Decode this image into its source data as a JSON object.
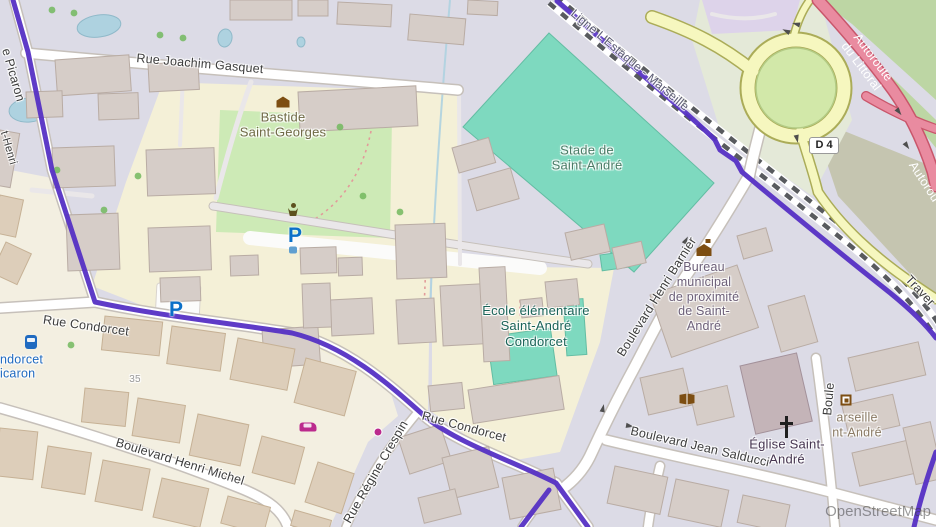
{
  "attribution": "OpenStreetMap",
  "shield": {
    "label": "D 4"
  },
  "colors": {
    "base": "#dcdbe6",
    "cream": "#f3efe1",
    "parkGreen": "#cdeab6",
    "schoolYellow": "#f4f0d7",
    "pitch": "#7ed9bf",
    "pitchBorder": "#63bda3",
    "khaki": "#c5c5b0",
    "scrub": "#bdd6a4",
    "roundBg": "#e4e9d8",
    "lavender": "#ddd3ea",
    "roadFill": "#ffffff",
    "roadCasing": "#c6c0ba",
    "trackFill": "#eae7e9",
    "yellowFill": "#f6f7bf",
    "yellowCasing": "#abac58",
    "greenCtr": "#d2e8a9",
    "motFill": "#e98ba0",
    "motCasing": "#c9566b",
    "railDark": "#585a5e",
    "route": "#5530c4",
    "water": "#aed2e0",
    "waterBorder": "#8fb9c9",
    "bldgG": "#d6cdc8",
    "bldgGB": "#b9aca4",
    "bldgT": "#ddceba",
    "bldgTB": "#c6b195",
    "church": "#c4b4b8",
    "churchB": "#a3919a",
    "tree": "#72b95e",
    "labelRoad": "#3c3c3c",
    "labelRail": "#5c5c74",
    "labelMot": "#ffffff",
    "labelGreen": "#4a7c66",
    "labelHist": "#6f6a45",
    "labelSchool": "#1a6358",
    "labelTown": "#6c5f78",
    "labelChurch": "#463550",
    "labelTan": "#8a7a64",
    "labelBus": "#1f6ac0",
    "labelHnum": "#9a9a9a",
    "parkingBlue": "#0b70c8",
    "iconBrown": "#7d4e12",
    "carMagenta": "#bb2a8d"
  },
  "labels": [
    {
      "name": "street-rue-joachim-gasquet",
      "text": "Rue Joachim Gasquet",
      "x": 200,
      "y": 64,
      "rot": 5,
      "cls": "road"
    },
    {
      "name": "street-picaron",
      "text": "e Picaron",
      "x": 13,
      "y": 75,
      "rot": 74,
      "cls": "road"
    },
    {
      "name": "street-henri",
      "text": "t-Henri",
      "x": 8,
      "y": 148,
      "rot": 74,
      "cls": "road sm"
    },
    {
      "name": "street-rue-condorcet-west",
      "text": "Rue Condorcet",
      "x": 86,
      "y": 326,
      "rot": 8,
      "cls": "road"
    },
    {
      "name": "street-rue-condorcet-east",
      "text": "Rue Condorcet",
      "x": 464,
      "y": 427,
      "rot": 15,
      "cls": "road"
    },
    {
      "name": "street-boulevard-henri-michel",
      "text": "Boulevard Henri Michel",
      "x": 180,
      "y": 462,
      "rot": 17,
      "cls": "road"
    },
    {
      "name": "street-rue-regine-crespin",
      "text": "Rue Régine Crespin",
      "x": 376,
      "y": 472,
      "rot": -60,
      "cls": "road"
    },
    {
      "name": "street-boulevard-henri-barnier",
      "text": "Boulevard Henri Barnier",
      "x": 657,
      "y": 297,
      "rot": -58,
      "cls": "road"
    },
    {
      "name": "street-boulevard-jean-salducci",
      "text": "Boulevard Jean Salducci",
      "x": 700,
      "y": 447,
      "rot": 13,
      "cls": "road"
    },
    {
      "name": "street-boule-partial",
      "text": "Boule",
      "x": 829,
      "y": 399,
      "rot": -85,
      "cls": "road"
    },
    {
      "name": "railway-ligne-lestaque-marseille",
      "text": "Ligne L'Estaque - Marseille",
      "x": 630,
      "y": 60,
      "rot": 40,
      "cls": "rail"
    },
    {
      "name": "motorway-autoroute-du-littoral",
      "text": "Autoroute du Littoral",
      "x": 867,
      "y": 62,
      "rot": 53,
      "cls": "mot"
    },
    {
      "name": "motorway-autoroute-partial",
      "text": "Autorou",
      "x": 924,
      "y": 182,
      "rot": 57,
      "cls": "mot"
    },
    {
      "name": "street-traverse-partial",
      "text": "Traver",
      "x": 920,
      "y": 291,
      "rot": 47,
      "cls": "road"
    },
    {
      "name": "poi-stade-de-saint-andre",
      "text": "Stade de\nSaint-André",
      "x": 587,
      "y": 158,
      "rot": 0,
      "cls": "poi green"
    },
    {
      "name": "poi-bastide-saint-georges",
      "text": "Bastide\nSaint-Georges",
      "x": 283,
      "y": 125,
      "rot": 0,
      "cls": "poi hist"
    },
    {
      "name": "poi-ecole-elementaire-saint-andre-condorcet",
      "text": "École élémentaire\nSaint-André\nCondorcet",
      "x": 536,
      "y": 326,
      "rot": 0,
      "cls": "poi school"
    },
    {
      "name": "poi-bureau-municipal",
      "text": "Bureau\nmunicipal\nde proximité\nde Saint-\nAndré",
      "x": 704,
      "y": 297,
      "rot": 0,
      "cls": "poi town"
    },
    {
      "name": "poi-eglise-saint-andre",
      "text": "Église Saint-\nAndré",
      "x": 787,
      "y": 452,
      "rot": 0,
      "cls": "poi church"
    },
    {
      "name": "poi-marseille-saint-andre-partial",
      "text": "arseille\nnt-André",
      "x": 857,
      "y": 425,
      "rot": 0,
      "cls": "poi tan"
    },
    {
      "name": "bus-stop-condorcet-line1",
      "text": "ndorcet",
      "x": 0,
      "y": 360,
      "rot": 0,
      "cls": "bus",
      "align": "left"
    },
    {
      "name": "bus-stop-condorcet-line2",
      "text": "icaron",
      "x": 0,
      "y": 374,
      "rot": 0,
      "cls": "bus",
      "align": "left"
    },
    {
      "name": "house-number-35",
      "text": "35",
      "x": 135,
      "y": 380,
      "rot": 0,
      "cls": "hnum"
    }
  ],
  "icons": [
    {
      "name": "manor-icon",
      "type": "manor",
      "x": 283,
      "y": 102
    },
    {
      "name": "townhall-icon",
      "type": "townhall",
      "x": 704,
      "y": 250
    },
    {
      "name": "statue-icon",
      "type": "statue",
      "x": 293,
      "y": 210
    },
    {
      "name": "parking-icon",
      "type": "parking",
      "x": 295,
      "y": 236,
      "glyph": "P"
    },
    {
      "name": "parking-icon-2",
      "type": "parking",
      "x": 176,
      "y": 310,
      "glyph": "P"
    },
    {
      "name": "water-tap-icon",
      "type": "tap",
      "x": 293,
      "y": 250
    },
    {
      "name": "bus-icon",
      "type": "bus",
      "x": 31,
      "y": 342
    },
    {
      "name": "car-shop-icon",
      "type": "car",
      "x": 308,
      "y": 427
    },
    {
      "name": "shop-dot-icon",
      "type": "dot",
      "x": 378,
      "y": 432
    },
    {
      "name": "library-icon",
      "type": "book",
      "x": 687,
      "y": 399
    },
    {
      "name": "postbox-icon",
      "type": "frame",
      "x": 846,
      "y": 400
    },
    {
      "name": "church-cross-icon",
      "type": "cross",
      "x": 786,
      "y": 427
    }
  ],
  "buildings": [
    [
      230,
      0,
      62,
      20,
      0,
      "g"
    ],
    [
      298,
      0,
      30,
      16,
      0,
      "g"
    ],
    [
      338,
      2,
      54,
      22,
      3,
      "g"
    ],
    [
      410,
      14,
      56,
      26,
      5,
      "g"
    ],
    [
      468,
      0,
      30,
      14,
      3,
      "g"
    ],
    [
      55,
      60,
      74,
      36,
      -4,
      "g"
    ],
    [
      148,
      64,
      50,
      28,
      -3,
      "g"
    ],
    [
      26,
      92,
      36,
      26,
      -2,
      "g"
    ],
    [
      98,
      94,
      40,
      26,
      -2,
      "g"
    ],
    [
      52,
      148,
      62,
      40,
      -2,
      "g"
    ],
    [
      146,
      150,
      68,
      46,
      -2,
      "g"
    ],
    [
      66,
      215,
      52,
      56,
      -2,
      "g"
    ],
    [
      148,
      228,
      62,
      44,
      -2,
      "g"
    ],
    [
      160,
      278,
      40,
      24,
      -2,
      "g"
    ],
    [
      0,
      130,
      20,
      55,
      10,
      "g"
    ],
    [
      0,
      195,
      24,
      38,
      12,
      "t"
    ],
    [
      6,
      242,
      28,
      34,
      25,
      "t"
    ],
    [
      298,
      92,
      118,
      40,
      -3,
      "g"
    ],
    [
      395,
      225,
      50,
      54,
      -2,
      "g"
    ],
    [
      300,
      248,
      36,
      26,
      -2,
      "g"
    ],
    [
      338,
      258,
      24,
      18,
      -2,
      "g"
    ],
    [
      230,
      256,
      28,
      20,
      -2,
      "g"
    ],
    [
      262,
      330,
      56,
      38,
      -4,
      "g"
    ],
    [
      330,
      300,
      42,
      36,
      -3,
      "g"
    ],
    [
      396,
      300,
      38,
      44,
      -3,
      "g"
    ],
    [
      302,
      284,
      28,
      44,
      -2,
      "g"
    ],
    [
      428,
      386,
      34,
      26,
      -6,
      "g"
    ],
    [
      452,
      148,
      38,
      26,
      -16,
      "g"
    ],
    [
      468,
      180,
      44,
      32,
      -16,
      "g"
    ],
    [
      440,
      286,
      52,
      60,
      -3,
      "g"
    ],
    [
      479,
      268,
      26,
      94,
      -3,
      "g"
    ],
    [
      468,
      390,
      92,
      34,
      -9,
      "g"
    ],
    [
      545,
      282,
      32,
      26,
      -6,
      "g"
    ],
    [
      520,
      300,
      22,
      18,
      -6,
      "g"
    ],
    [
      565,
      233,
      40,
      28,
      -13,
      "g"
    ],
    [
      612,
      248,
      30,
      22,
      -13,
      "g"
    ],
    [
      650,
      295,
      92,
      66,
      -19,
      "g"
    ],
    [
      737,
      236,
      30,
      24,
      -16,
      "g"
    ],
    [
      768,
      306,
      38,
      48,
      -16,
      "g"
    ],
    [
      640,
      378,
      44,
      38,
      -13,
      "g"
    ],
    [
      690,
      394,
      38,
      32,
      -13,
      "g"
    ],
    [
      740,
      366,
      58,
      70,
      -13,
      "c"
    ],
    [
      848,
      358,
      72,
      34,
      -13,
      "g"
    ],
    [
      842,
      406,
      52,
      32,
      -13,
      "g"
    ],
    [
      852,
      453,
      62,
      34,
      -13,
      "g"
    ],
    [
      903,
      428,
      28,
      58,
      -13,
      "g"
    ],
    [
      615,
      466,
      54,
      38,
      12,
      "g"
    ],
    [
      676,
      479,
      54,
      38,
      12,
      "g"
    ],
    [
      743,
      495,
      48,
      28,
      12,
      "g"
    ],
    [
      105,
      316,
      58,
      34,
      6,
      "t"
    ],
    [
      172,
      326,
      54,
      38,
      8,
      "t"
    ],
    [
      238,
      338,
      58,
      42,
      11,
      "t"
    ],
    [
      306,
      358,
      52,
      46,
      15,
      "t"
    ],
    [
      85,
      388,
      44,
      34,
      6,
      "t"
    ],
    [
      138,
      398,
      48,
      38,
      9,
      "t"
    ],
    [
      198,
      414,
      52,
      42,
      12,
      "t"
    ],
    [
      262,
      436,
      44,
      38,
      15,
      "t"
    ],
    [
      318,
      462,
      38,
      42,
      18,
      "t"
    ],
    [
      0,
      428,
      38,
      48,
      6,
      "t"
    ],
    [
      48,
      446,
      44,
      42,
      9,
      "t"
    ],
    [
      103,
      460,
      48,
      42,
      11,
      "t"
    ],
    [
      162,
      478,
      48,
      40,
      13,
      "t"
    ],
    [
      228,
      496,
      44,
      28,
      15,
      "t"
    ],
    [
      295,
      510,
      38,
      16,
      16,
      "t"
    ],
    [
      398,
      438,
      44,
      38,
      -18,
      "g"
    ],
    [
      442,
      458,
      48,
      42,
      -14,
      "g"
    ],
    [
      502,
      478,
      52,
      42,
      -11,
      "g"
    ],
    [
      418,
      498,
      38,
      26,
      -14,
      "g"
    ]
  ],
  "pitches": [
    [
      487,
      337,
      64,
      48,
      -8
    ],
    [
      563,
      300,
      20,
      56,
      -4
    ],
    [
      600,
      255,
      28,
      16,
      -8
    ]
  ],
  "ponds": [
    [
      99,
      26,
      22,
      11,
      -8
    ],
    [
      225,
      38,
      7,
      9,
      10
    ],
    [
      301,
      42,
      4,
      5,
      0
    ],
    [
      29,
      110,
      20,
      12,
      -5
    ]
  ],
  "trees": [
    [
      52,
      10
    ],
    [
      74,
      13
    ],
    [
      160,
      35
    ],
    [
      183,
      38
    ],
    [
      57,
      170
    ],
    [
      138,
      176
    ],
    [
      104,
      210
    ],
    [
      363,
      196
    ],
    [
      400,
      212
    ],
    [
      340,
      127
    ],
    [
      71,
      345
    ]
  ],
  "arrows": [
    [
      796,
      24,
      195
    ],
    [
      786,
      31,
      205
    ],
    [
      797,
      139,
      78
    ],
    [
      899,
      112,
      52
    ],
    [
      907,
      146,
      55
    ],
    [
      630,
      426,
      10
    ],
    [
      686,
      240,
      -62
    ],
    [
      603,
      408,
      -78
    ]
  ]
}
